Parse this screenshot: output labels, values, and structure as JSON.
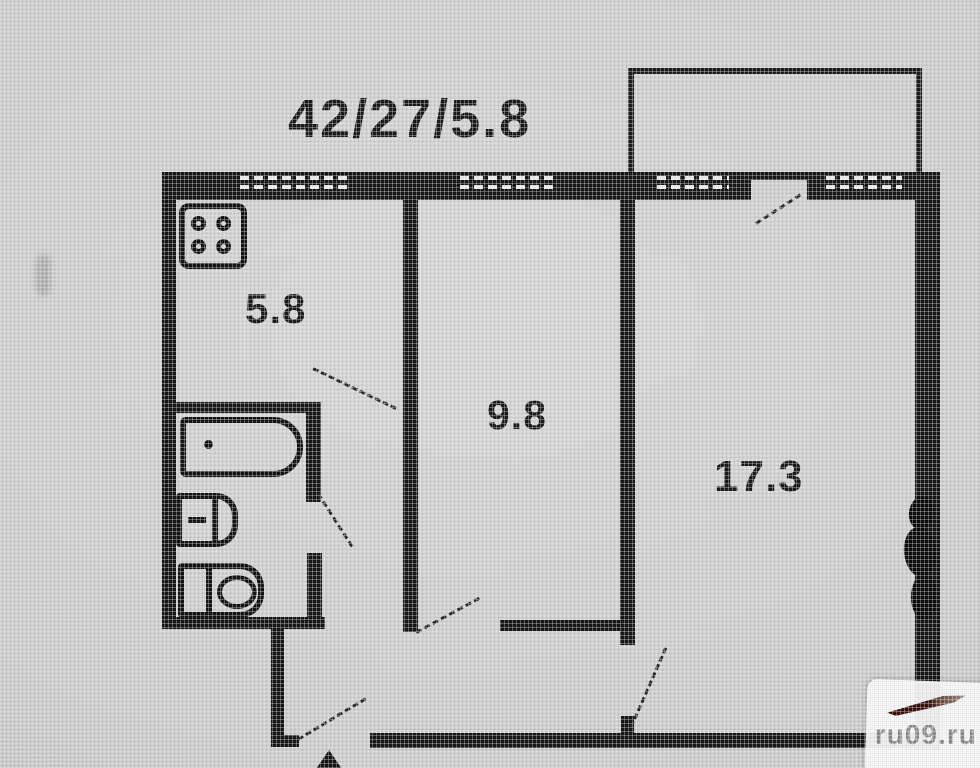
{
  "plan": {
    "title": "42/27/5.8",
    "rooms": [
      {
        "id": "kitchen",
        "area": "5.8"
      },
      {
        "id": "room-middle",
        "area": "9.8"
      },
      {
        "id": "room-living",
        "area": "17.3"
      }
    ],
    "fixtures": [
      "stove",
      "bathtub",
      "sink",
      "toilet"
    ],
    "features": {
      "balcony": true,
      "windows": 4,
      "door_swings": 6,
      "entrance_mark": true
    }
  },
  "watermark": {
    "text": "ru09.ru"
  },
  "colors": {
    "background": "#d0d0d0",
    "wall": "#171717",
    "watermark_text": "#8d8d8d",
    "logo_accent": "#39100a"
  }
}
